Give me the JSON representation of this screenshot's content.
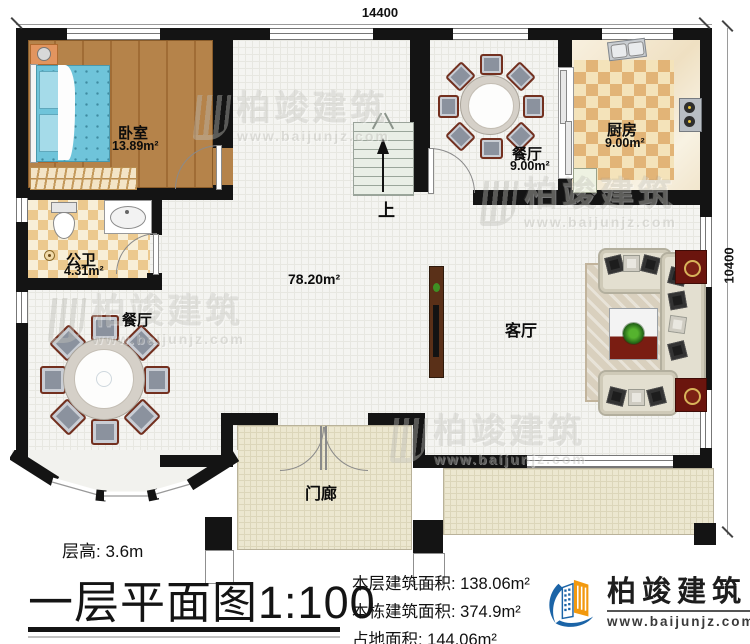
{
  "dimensions": {
    "width_label": "14400",
    "height_label": "10400"
  },
  "rooms": {
    "bedroom": {
      "name": "卧室",
      "area": "13.89m²"
    },
    "bathroom": {
      "name": "公卫",
      "area": "4.31m²"
    },
    "dining_left": {
      "name": "餐厅"
    },
    "dining_top": {
      "name": "餐厅",
      "area": "9.00m²"
    },
    "kitchen": {
      "name": "厨房",
      "area": "9.00m²"
    },
    "living": {
      "name": "客厅"
    },
    "hall": {
      "area": "78.20m²"
    },
    "porch": {
      "name": "门廊"
    },
    "stairs": {
      "up_label": "上"
    }
  },
  "footer": {
    "floor_height": "层高: 3.6m",
    "plan_title": "一层平面图",
    "plan_scale": "1:100",
    "stats": [
      "本层建筑面积: 138.06m²",
      "本栋建筑面积: 374.9m²",
      "占地面积: 144.06m²"
    ]
  },
  "brand": {
    "name": "柏竣建筑",
    "url": "www.baijunjz.com"
  },
  "watermark": {
    "name": "柏竣建筑",
    "url": "www.baijunjz.com"
  },
  "colors": {
    "brand_blue": "#1b64a7",
    "brand_orange": "#f2990f",
    "wall": "#141414"
  }
}
